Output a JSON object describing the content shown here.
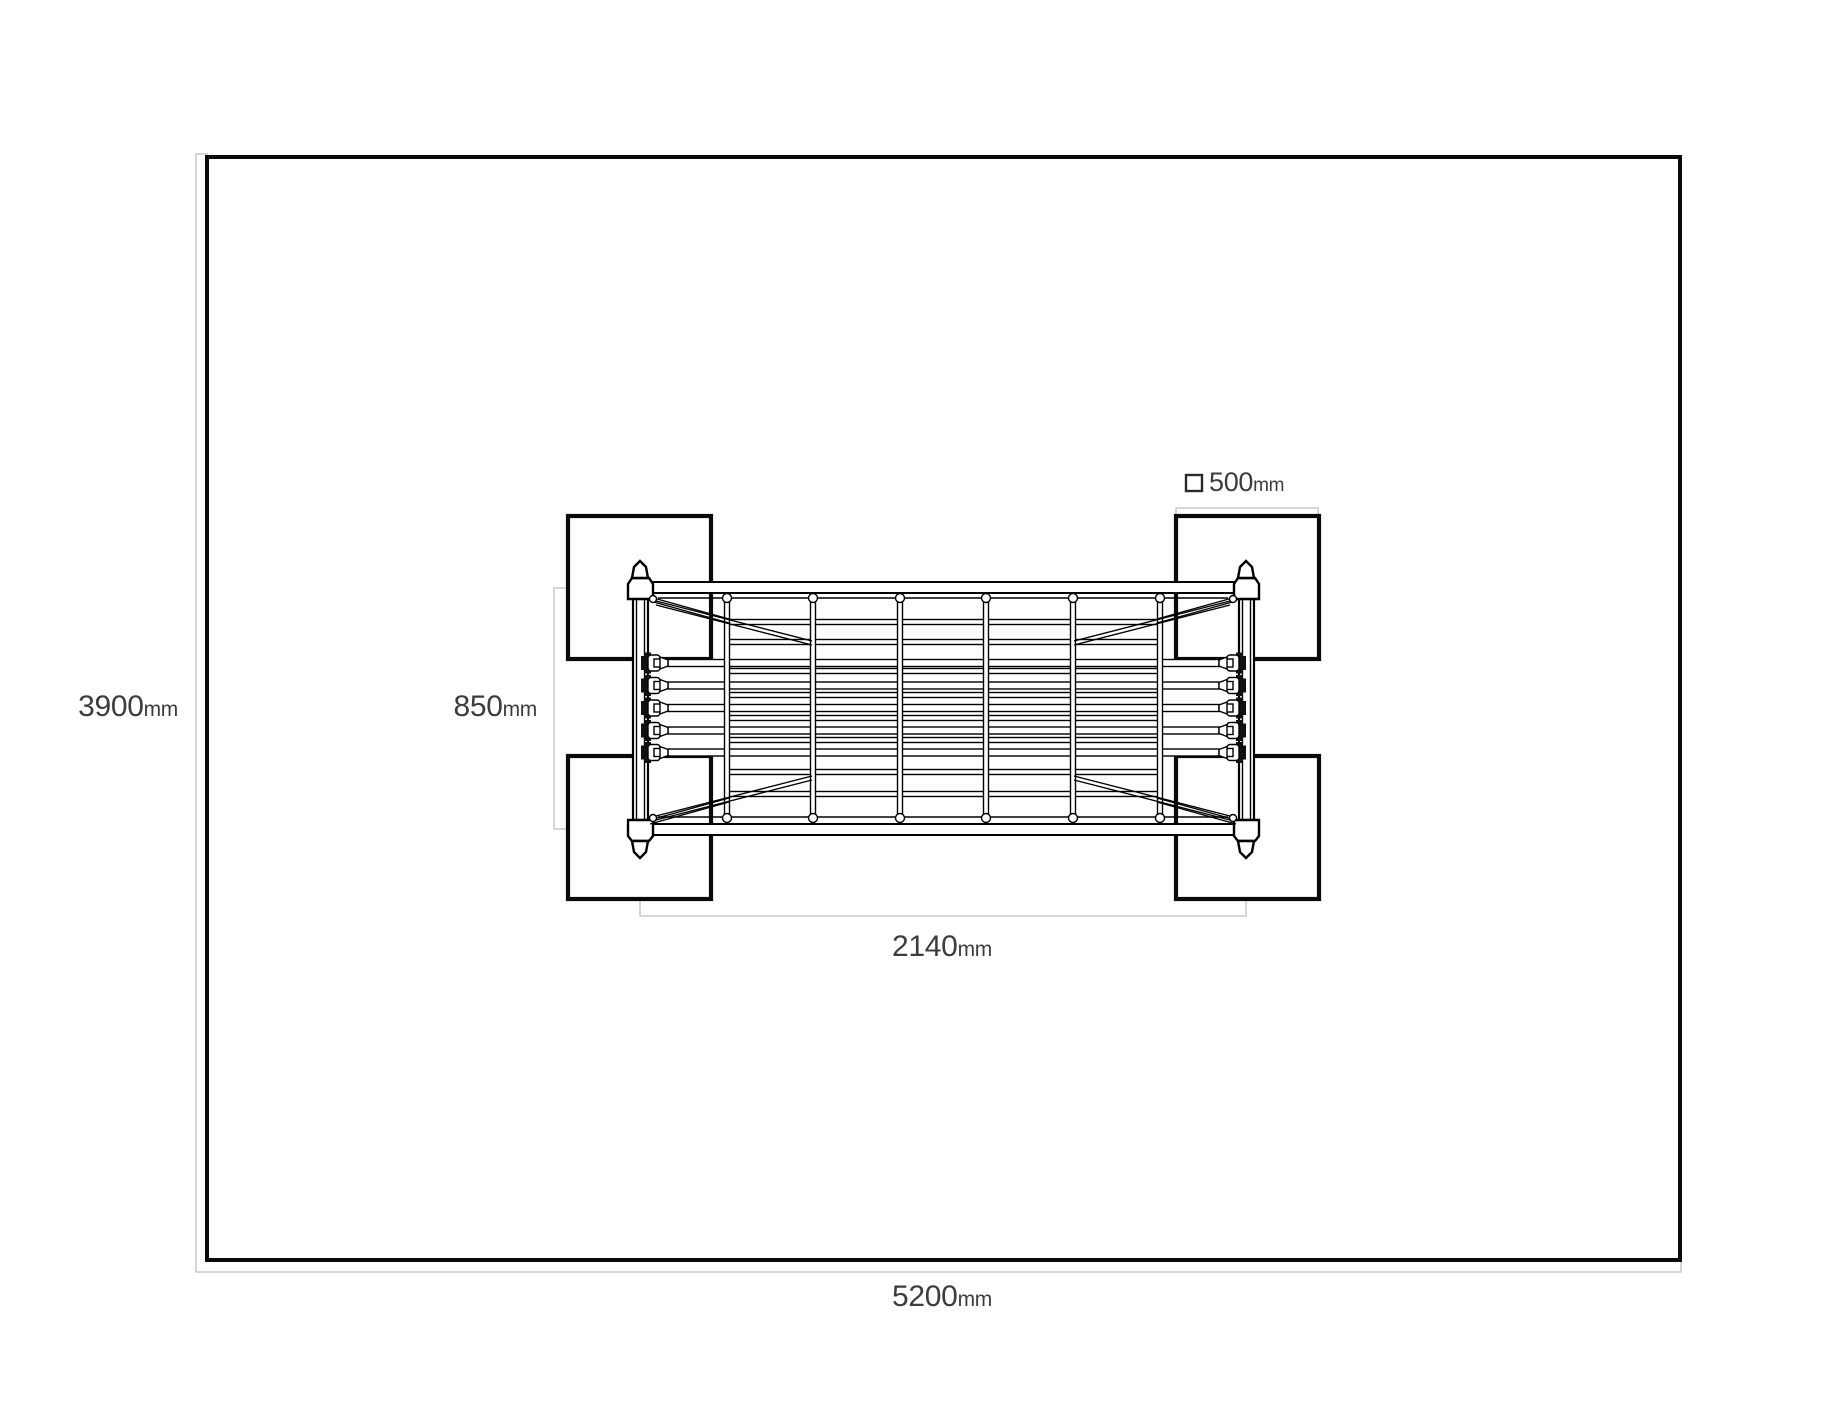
{
  "labels": {
    "area_width": {
      "value": "5200",
      "unit": "mm"
    },
    "area_depth": {
      "value": "3900",
      "unit": "mm"
    },
    "apparatus_width": {
      "value": "2140",
      "unit": "mm"
    },
    "apparatus_depth": {
      "value": "850",
      "unit": "mm"
    },
    "pad_size": {
      "value": "500",
      "unit": "mm"
    }
  },
  "legend": {
    "icon": "square-icon"
  },
  "colors": {
    "line": "#000000",
    "border": "#0a0a0a",
    "dim-line": "#c9c9c9",
    "label-text": "#3d3d3d",
    "bg": "#ffffff"
  }
}
